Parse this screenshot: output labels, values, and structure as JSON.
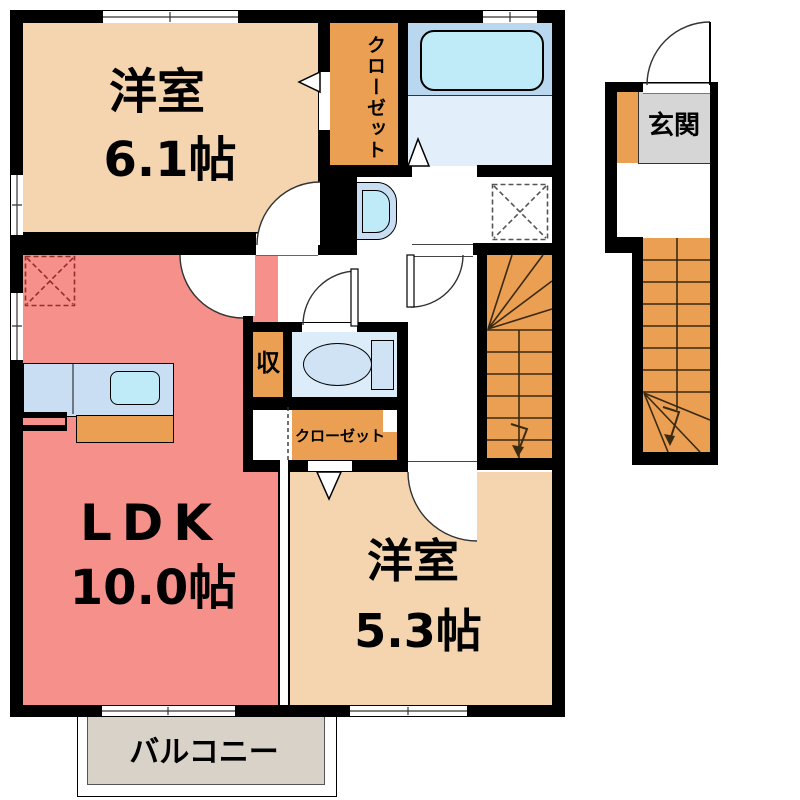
{
  "rooms": {
    "western1": {
      "name": "洋室",
      "size": "6.1帖"
    },
    "ldk": {
      "name": "LDK",
      "size": "10.0帖"
    },
    "western2": {
      "name": "洋室",
      "size": "5.3帖"
    }
  },
  "labels": {
    "closet_top": "クローゼット",
    "closet_bottom": "クローゼット",
    "storage": "収",
    "entrance": "玄関",
    "balcony": "バルコニー"
  },
  "colors": {
    "wall": "#000000",
    "room_peach": "#F4D5B0",
    "ldk_salmon": "#F6908B",
    "closet_orange": "#EA9F52",
    "bath_upper": "#B9D8F0",
    "bath_lower": "#E2EFFB",
    "toilet_floor": "#DCECF9",
    "fixture_blue": "#C9DEF2",
    "fixture_cyan": "#BEEBF7",
    "genkan_gray": "#D6D6D6",
    "balcony_gray": "#D9D2C9"
  }
}
